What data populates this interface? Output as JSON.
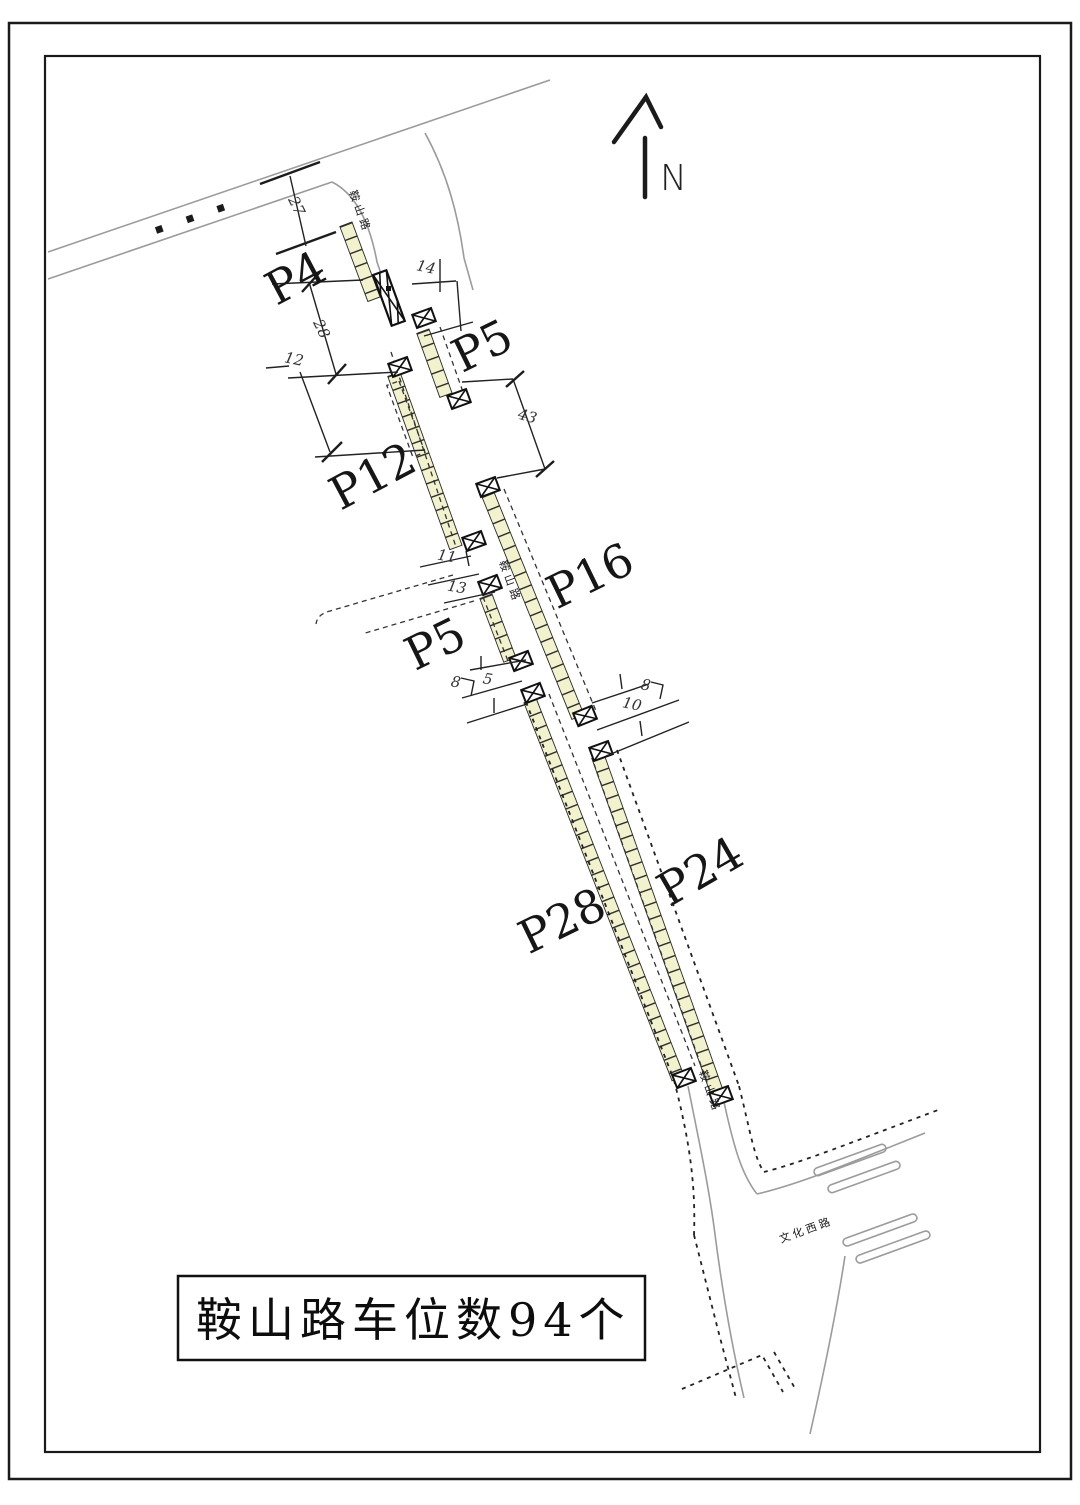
{
  "north_label": "N",
  "title_box": {
    "text": "鞍山路车位数94个"
  },
  "zones": [
    {
      "label": "P4"
    },
    {
      "label": "P5"
    },
    {
      "label": "P12"
    },
    {
      "label": "P16"
    },
    {
      "label": "P5"
    },
    {
      "label": "P28"
    },
    {
      "label": "P24"
    }
  ],
  "dimensions": [
    {
      "value": "27"
    },
    {
      "value": "28"
    },
    {
      "value": "12"
    },
    {
      "value": "14"
    },
    {
      "value": "43"
    },
    {
      "value": "11"
    },
    {
      "value": "13"
    },
    {
      "value": "8"
    },
    {
      "value": "5"
    },
    {
      "value": "8"
    },
    {
      "value": "10"
    }
  ],
  "road_names": {
    "anshan_top": "鞍山路",
    "anshan_mid": "鞍山路",
    "anshan_bottom": "鞍山路",
    "wenhua": "文化西路",
    "cross_road_top_glyphs": "■■■"
  },
  "colors": {
    "parking_strip_fill": "#f3f2cf",
    "road_line_gray": "#9b9b9b",
    "ink": "#1f1f1f",
    "background": "#ffffff"
  }
}
